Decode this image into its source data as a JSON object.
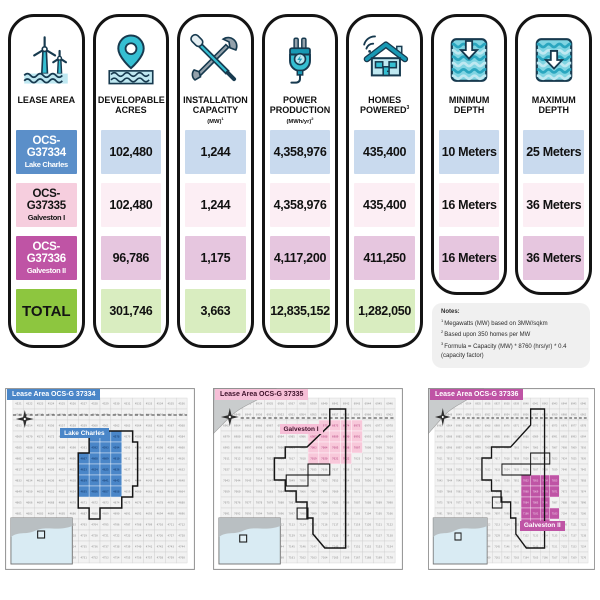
{
  "table": {
    "columns": [
      {
        "header": "LEASE AREA",
        "icon": "wind-turbines-icon"
      },
      {
        "header": "DEVELOPABLE ACRES",
        "icon": "map-pin-water-icon"
      },
      {
        "header": "INSTALLATION CAPACITY",
        "unit": "(MW)",
        "sup": "1",
        "icon": "tools-icon"
      },
      {
        "header": "POWER PRODUCTION",
        "unit": "(MWh/yr)",
        "sup": "2",
        "icon": "power-plug-icon"
      },
      {
        "header": "HOMES POWERED",
        "sup": "3",
        "icon": "connected-home-icon"
      },
      {
        "header": "MINIMUM DEPTH",
        "icon": "minimum-depth-icon"
      },
      {
        "header": "MAXIMUM DEPTH",
        "icon": "maximum-depth-icon"
      }
    ],
    "rows": [
      {
        "code": "OCS-G37334",
        "name": "Lake Charles",
        "developable_acres": "102,480",
        "installation_capacity_mw": "1,244",
        "power_production_mwh_yr": "4,358,976",
        "homes_powered": "435,400",
        "minimum_depth": "10 Meters",
        "maximum_depth": "25 Meters"
      },
      {
        "code": "OCS-G37335",
        "name": "Galveston I",
        "developable_acres": "102,480",
        "installation_capacity_mw": "1,244",
        "power_production_mwh_yr": "4,358,976",
        "homes_powered": "435,400",
        "minimum_depth": "16 Meters",
        "maximum_depth": "36 Meters"
      },
      {
        "code": "OCS-G37336",
        "name": "Galveston II",
        "developable_acres": "96,786",
        "installation_capacity_mw": "1,175",
        "power_production_mwh_yr": "4,117,200",
        "homes_powered": "411,250",
        "minimum_depth": "16 Meters",
        "maximum_depth": "36 Meters"
      }
    ],
    "total": {
      "label": "TOTAL",
      "developable_acres": "301,746",
      "installation_capacity_mw": "3,663",
      "power_production_mwh_yr": "12,835,152",
      "homes_powered": "1,282,050"
    }
  },
  "notes": {
    "title": "Notes:",
    "items": [
      {
        "sup": "1",
        "text": "Megawatts (MW) based on 3MW/sqkm"
      },
      {
        "sup": "2",
        "text": "Based upon 350 homes per MW"
      },
      {
        "sup": "3",
        "text": "Formula = Capacity (MW) * 8760 (hrs/yr) * 0.4 (capacity factor)"
      }
    ]
  },
  "colors": {
    "lease1_accent": "#5b8fc9",
    "lease1_light": "#c9daee",
    "lease2_accent": "#f6cede",
    "lease2_light": "#fceef4",
    "lease3_accent": "#bf54a5",
    "lease3_light": "#e6c6df",
    "total_accent": "#8dc63f",
    "total_light": "#d9edc0",
    "icon_teal": "#35bfd2",
    "icon_dark": "#173a4f"
  },
  "maps": [
    {
      "title": "Lease Area OCS-G 37334",
      "area_label": "Lake Charles",
      "title_bg": "#4a86c8",
      "title_color": "#ffffff",
      "highlight": "#4a86c8",
      "highlight_text": "#0d2f5e",
      "grid": {
        "cols": 16,
        "rows": 15,
        "cell": 11,
        "ox": 8,
        "oy": 10,
        "block_start": 4521
      },
      "land": false,
      "dashed_y": 27,
      "compass": [
        20,
        31
      ],
      "outline": "M85 43 H129 V54 H134 V98 H129 V109 H118 V120 H96 V131 H85 V120 H74 V65 H85 Z",
      "inner_rects": [],
      "cells": [
        [
          7,
          3
        ],
        [
          8,
          3
        ],
        [
          9,
          3
        ],
        [
          7,
          4
        ],
        [
          8,
          4
        ],
        [
          9,
          4
        ],
        [
          6,
          5
        ],
        [
          7,
          5
        ],
        [
          8,
          5
        ],
        [
          9,
          5
        ],
        [
          6,
          6
        ],
        [
          7,
          6
        ],
        [
          8,
          6
        ],
        [
          9,
          6
        ],
        [
          6,
          7
        ],
        [
          7,
          7
        ],
        [
          8,
          7
        ],
        [
          9,
          7
        ],
        [
          6,
          8
        ],
        [
          7,
          8
        ],
        [
          8,
          8
        ],
        [
          9,
          8
        ]
      ],
      "area_label_pos": [
        29,
        22
      ],
      "locator": [
        27,
        13
      ]
    },
    {
      "title": "Lease Area OCS-G 37335",
      "area_label": "Galveston I",
      "title_bg": "#f6bfd7",
      "title_color": "#3c1129",
      "highlight": "#f8c8da",
      "highlight_text": "#b2407e",
      "grid": {
        "cols": 16,
        "rows": 15,
        "cell": 11,
        "ox": 8,
        "oy": 10,
        "block_start": 6931
      },
      "land": true,
      "dashed_y": 30,
      "compass": [
        17,
        29
      ],
      "outline": "M118 21 H134 V160 H113 L101 146 V130 H95 V114 H84 V103 H73 V92 H62 V70 H73 V59 H95 L118 37 Z",
      "inner_rects": [
        [
          96,
          76,
          22,
          11
        ],
        [
          74,
          87,
          22,
          11
        ],
        [
          85,
          120,
          11,
          11
        ]
      ],
      "cells": [
        [
          9,
          2
        ],
        [
          10,
          2
        ],
        [
          11,
          2
        ],
        [
          12,
          2
        ],
        [
          8,
          3
        ],
        [
          9,
          3
        ],
        [
          10,
          3
        ],
        [
          11,
          3
        ],
        [
          12,
          3
        ],
        [
          8,
          4
        ],
        [
          9,
          4
        ],
        [
          10,
          4
        ],
        [
          11,
          4
        ],
        [
          12,
          4
        ],
        [
          8,
          5
        ],
        [
          9,
          5
        ],
        [
          10,
          5
        ],
        [
          11,
          5
        ]
      ],
      "area_label_pos": [
        35,
        20
      ],
      "locator": [
        21,
        17
      ]
    },
    {
      "title": "Lease Area OCS-G 37336",
      "area_label": "Galveston II",
      "title_bg": "#bf54a5",
      "title_color": "#ffffff",
      "highlight": "#bf54a5",
      "highlight_text": "#f3d8ec",
      "grid": {
        "cols": 16,
        "rows": 15,
        "cell": 11,
        "ox": 8,
        "oy": 10,
        "block_start": 6931
      },
      "land": true,
      "dashed_y": 30,
      "compass": [
        17,
        29
      ],
      "outline": "M118 21 H134 V160 H113 L101 146 V130 H95 V114 H84 V103 H73 V92 H62 V70 H73 V59 H95 L118 37 Z",
      "inner_rects": [
        [
          118,
          65,
          22,
          11
        ],
        [
          85,
          76,
          33,
          11
        ],
        [
          74,
          109,
          11,
          11
        ]
      ],
      "cells": [
        [
          9,
          7
        ],
        [
          10,
          7
        ],
        [
          11,
          7
        ],
        [
          12,
          7
        ],
        [
          9,
          8
        ],
        [
          10,
          8
        ],
        [
          11,
          8
        ],
        [
          12,
          8
        ],
        [
          9,
          9
        ],
        [
          10,
          9
        ],
        [
          11,
          9
        ],
        [
          9,
          10
        ],
        [
          10,
          10
        ],
        [
          11,
          10
        ],
        [
          12,
          10
        ],
        [
          9,
          11
        ],
        [
          10,
          11
        ],
        [
          11,
          11
        ]
      ],
      "area_label_pos": [
        55,
        73
      ],
      "locator": [
        25,
        15
      ]
    }
  ]
}
